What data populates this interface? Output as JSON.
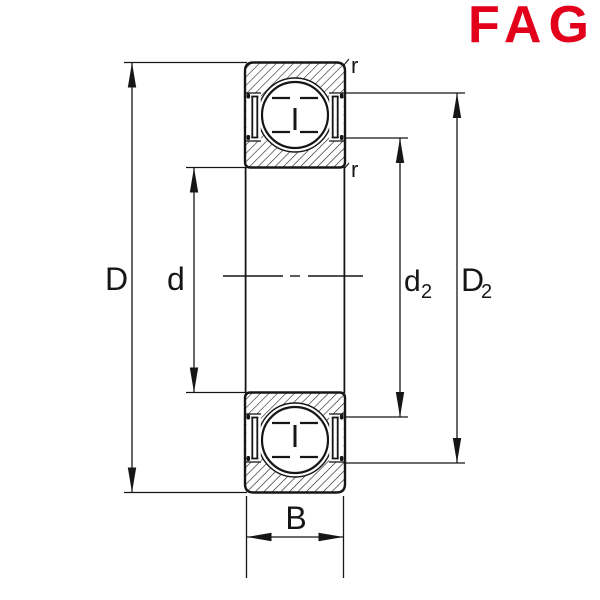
{
  "logo": {
    "text": "FAG",
    "color": "#E2001A"
  },
  "dimension_labels": {
    "outside_diameter": "D",
    "bore_diameter": "d",
    "inner_shoulder_main": "d",
    "inner_shoulder_sub": "2",
    "outer_shoulder_main": "D",
    "outer_shoulder_sub": "2",
    "width": "B",
    "chamfer_outer": "r",
    "chamfer_inner": "r"
  },
  "colors": {
    "line": "#161616",
    "background": "#ffffff",
    "logo_red": "#E2001A"
  }
}
